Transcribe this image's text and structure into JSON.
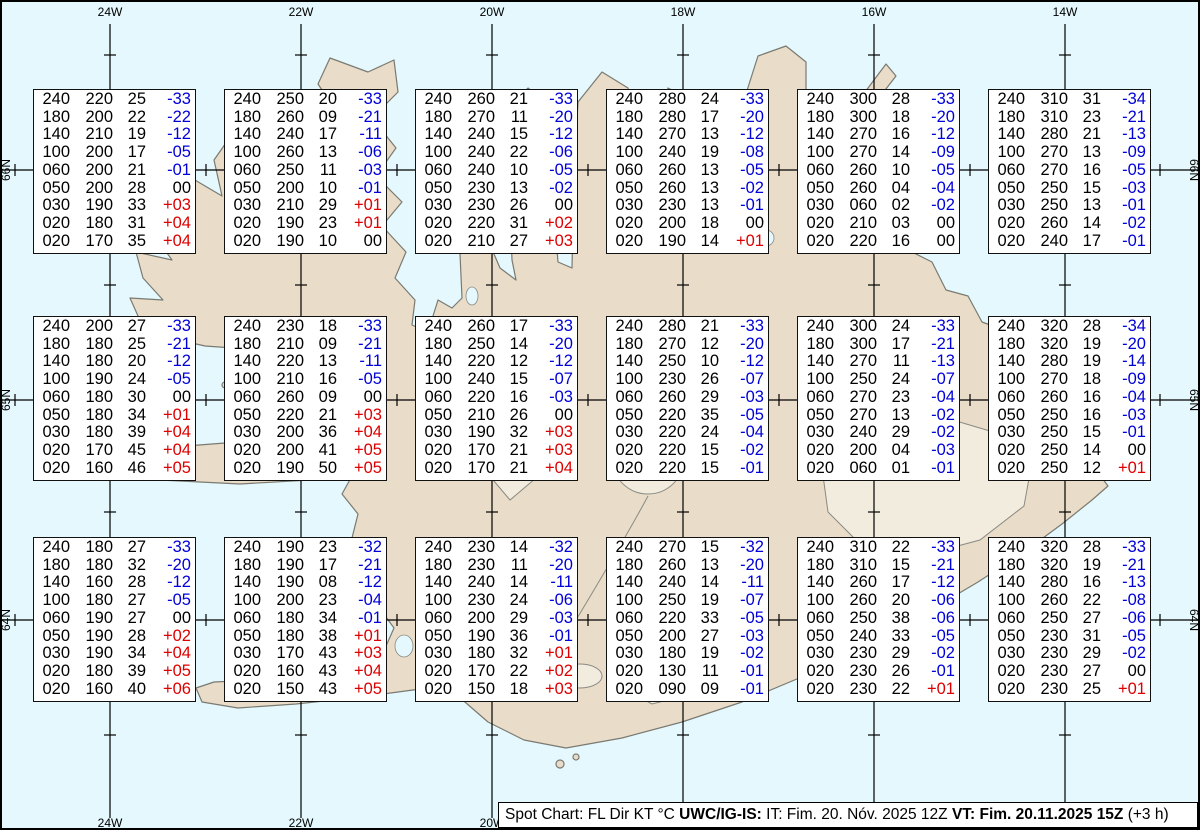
{
  "colors": {
    "ocean": "#e4f8fd",
    "land": "#e9dcc8",
    "glacier": "#f2ecdf",
    "coast": "#7a7a72",
    "grid": "#000000",
    "temp_negative": "#0000d8",
    "temp_positive": "#dd0000"
  },
  "grid": {
    "meridians": [
      {
        "label": "24W",
        "x": 110
      },
      {
        "label": "22W",
        "x": 301
      },
      {
        "label": "20W",
        "x": 492
      },
      {
        "label": "18W",
        "x": 683
      },
      {
        "label": "16W",
        "x": 874
      },
      {
        "label": "14W",
        "x": 1065
      }
    ],
    "parallels": [
      {
        "label": "66N",
        "y": 170
      },
      {
        "label": "65N",
        "y": 400
      },
      {
        "label": "64N",
        "y": 620
      }
    ],
    "minor_meridian_x": [
      15,
      206,
      397,
      588,
      779,
      970,
      1160
    ],
    "minor_parallel_y": [
      55,
      285,
      512,
      735
    ]
  },
  "spot_boxes": [
    {
      "row": 1,
      "col": 1,
      "lines": [
        [
          "240",
          "220",
          "25",
          "-33"
        ],
        [
          "180",
          "200",
          "22",
          "-22"
        ],
        [
          "140",
          "210",
          "19",
          "-12"
        ],
        [
          "100",
          "200",
          "17",
          "-05"
        ],
        [
          "060",
          "200",
          "21",
          "-01"
        ],
        [
          "050",
          "200",
          "28",
          "00"
        ],
        [
          "030",
          "190",
          "33",
          "+03"
        ],
        [
          "020",
          "180",
          "31",
          "+04"
        ],
        [
          "020",
          "170",
          "35",
          "+04"
        ]
      ]
    },
    {
      "row": 1,
      "col": 2,
      "lines": [
        [
          "240",
          "250",
          "20",
          "-33"
        ],
        [
          "180",
          "260",
          "09",
          "-21"
        ],
        [
          "140",
          "240",
          "17",
          "-11"
        ],
        [
          "100",
          "260",
          "13",
          "-06"
        ],
        [
          "060",
          "250",
          "11",
          "-03"
        ],
        [
          "050",
          "200",
          "10",
          "-01"
        ],
        [
          "030",
          "210",
          "29",
          "+01"
        ],
        [
          "020",
          "190",
          "23",
          "+01"
        ],
        [
          "020",
          "190",
          "10",
          "00"
        ]
      ]
    },
    {
      "row": 1,
      "col": 3,
      "lines": [
        [
          "240",
          "260",
          "21",
          "-33"
        ],
        [
          "180",
          "270",
          "11",
          "-20"
        ],
        [
          "140",
          "240",
          "15",
          "-12"
        ],
        [
          "100",
          "240",
          "22",
          "-06"
        ],
        [
          "060",
          "240",
          "10",
          "-05"
        ],
        [
          "050",
          "230",
          "13",
          "-02"
        ],
        [
          "030",
          "230",
          "26",
          "00"
        ],
        [
          "020",
          "220",
          "31",
          "+02"
        ],
        [
          "020",
          "210",
          "27",
          "+03"
        ]
      ]
    },
    {
      "row": 1,
      "col": 4,
      "lines": [
        [
          "240",
          "280",
          "24",
          "-33"
        ],
        [
          "180",
          "280",
          "17",
          "-20"
        ],
        [
          "140",
          "270",
          "13",
          "-12"
        ],
        [
          "100",
          "240",
          "19",
          "-08"
        ],
        [
          "060",
          "260",
          "13",
          "-05"
        ],
        [
          "050",
          "260",
          "13",
          "-02"
        ],
        [
          "030",
          "230",
          "13",
          "-01"
        ],
        [
          "020",
          "200",
          "18",
          "00"
        ],
        [
          "020",
          "190",
          "14",
          "+01"
        ]
      ]
    },
    {
      "row": 1,
      "col": 5,
      "lines": [
        [
          "240",
          "300",
          "28",
          "-33"
        ],
        [
          "180",
          "300",
          "18",
          "-20"
        ],
        [
          "140",
          "270",
          "16",
          "-12"
        ],
        [
          "100",
          "270",
          "14",
          "-09"
        ],
        [
          "060",
          "260",
          "10",
          "-05"
        ],
        [
          "050",
          "260",
          "04",
          "-04"
        ],
        [
          "030",
          "060",
          "02",
          "-02"
        ],
        [
          "020",
          "210",
          "03",
          "00"
        ],
        [
          "020",
          "220",
          "16",
          "00"
        ]
      ]
    },
    {
      "row": 1,
      "col": 6,
      "lines": [
        [
          "240",
          "310",
          "31",
          "-34"
        ],
        [
          "180",
          "310",
          "23",
          "-21"
        ],
        [
          "140",
          "280",
          "21",
          "-13"
        ],
        [
          "100",
          "270",
          "13",
          "-09"
        ],
        [
          "060",
          "270",
          "16",
          "-05"
        ],
        [
          "050",
          "250",
          "15",
          "-03"
        ],
        [
          "030",
          "250",
          "13",
          "-01"
        ],
        [
          "020",
          "260",
          "14",
          "-02"
        ],
        [
          "020",
          "240",
          "17",
          "-01"
        ]
      ]
    },
    {
      "row": 2,
      "col": 1,
      "lines": [
        [
          "240",
          "200",
          "27",
          "-33"
        ],
        [
          "180",
          "180",
          "25",
          "-21"
        ],
        [
          "140",
          "180",
          "20",
          "-12"
        ],
        [
          "100",
          "190",
          "24",
          "-05"
        ],
        [
          "060",
          "180",
          "30",
          "00"
        ],
        [
          "050",
          "180",
          "34",
          "+01"
        ],
        [
          "030",
          "180",
          "39",
          "+04"
        ],
        [
          "020",
          "170",
          "45",
          "+04"
        ],
        [
          "020",
          "160",
          "46",
          "+05"
        ]
      ]
    },
    {
      "row": 2,
      "col": 2,
      "lines": [
        [
          "240",
          "230",
          "18",
          "-33"
        ],
        [
          "180",
          "210",
          "09",
          "-21"
        ],
        [
          "140",
          "220",
          "13",
          "-11"
        ],
        [
          "100",
          "210",
          "16",
          "-05"
        ],
        [
          "060",
          "260",
          "09",
          "00"
        ],
        [
          "050",
          "220",
          "21",
          "+03"
        ],
        [
          "030",
          "200",
          "36",
          "+04"
        ],
        [
          "020",
          "200",
          "41",
          "+05"
        ],
        [
          "020",
          "190",
          "50",
          "+05"
        ]
      ]
    },
    {
      "row": 2,
      "col": 3,
      "lines": [
        [
          "240",
          "260",
          "17",
          "-33"
        ],
        [
          "180",
          "250",
          "14",
          "-20"
        ],
        [
          "140",
          "220",
          "12",
          "-12"
        ],
        [
          "100",
          "240",
          "15",
          "-07"
        ],
        [
          "060",
          "220",
          "16",
          "-03"
        ],
        [
          "050",
          "210",
          "26",
          "00"
        ],
        [
          "030",
          "190",
          "32",
          "+03"
        ],
        [
          "020",
          "170",
          "21",
          "+03"
        ],
        [
          "020",
          "170",
          "21",
          "+04"
        ]
      ]
    },
    {
      "row": 2,
      "col": 4,
      "lines": [
        [
          "240",
          "280",
          "21",
          "-33"
        ],
        [
          "180",
          "270",
          "12",
          "-20"
        ],
        [
          "140",
          "250",
          "10",
          "-12"
        ],
        [
          "100",
          "230",
          "26",
          "-07"
        ],
        [
          "060",
          "260",
          "29",
          "-03"
        ],
        [
          "050",
          "220",
          "35",
          "-05"
        ],
        [
          "030",
          "220",
          "24",
          "-04"
        ],
        [
          "020",
          "220",
          "15",
          "-02"
        ],
        [
          "020",
          "220",
          "15",
          "-01"
        ]
      ]
    },
    {
      "row": 2,
      "col": 5,
      "lines": [
        [
          "240",
          "300",
          "24",
          "-33"
        ],
        [
          "180",
          "300",
          "17",
          "-21"
        ],
        [
          "140",
          "270",
          "11",
          "-13"
        ],
        [
          "100",
          "250",
          "24",
          "-07"
        ],
        [
          "060",
          "270",
          "23",
          "-04"
        ],
        [
          "050",
          "270",
          "13",
          "-02"
        ],
        [
          "030",
          "240",
          "29",
          "-02"
        ],
        [
          "020",
          "200",
          "04",
          "-03"
        ],
        [
          "020",
          "060",
          "01",
          "-01"
        ]
      ]
    },
    {
      "row": 2,
      "col": 6,
      "lines": [
        [
          "240",
          "320",
          "28",
          "-34"
        ],
        [
          "180",
          "320",
          "19",
          "-20"
        ],
        [
          "140",
          "280",
          "19",
          "-14"
        ],
        [
          "100",
          "270",
          "18",
          "-09"
        ],
        [
          "060",
          "260",
          "16",
          "-04"
        ],
        [
          "050",
          "250",
          "16",
          "-03"
        ],
        [
          "030",
          "250",
          "15",
          "-01"
        ],
        [
          "020",
          "250",
          "14",
          "00"
        ],
        [
          "020",
          "250",
          "12",
          "+01"
        ]
      ]
    },
    {
      "row": 3,
      "col": 1,
      "lines": [
        [
          "240",
          "180",
          "27",
          "-33"
        ],
        [
          "180",
          "180",
          "32",
          "-20"
        ],
        [
          "140",
          "160",
          "28",
          "-12"
        ],
        [
          "100",
          "180",
          "27",
          "-05"
        ],
        [
          "060",
          "190",
          "27",
          "00"
        ],
        [
          "050",
          "190",
          "28",
          "+02"
        ],
        [
          "030",
          "190",
          "34",
          "+04"
        ],
        [
          "020",
          "180",
          "39",
          "+05"
        ],
        [
          "020",
          "160",
          "40",
          "+06"
        ]
      ]
    },
    {
      "row": 3,
      "col": 2,
      "lines": [
        [
          "240",
          "190",
          "23",
          "-32"
        ],
        [
          "180",
          "190",
          "17",
          "-21"
        ],
        [
          "140",
          "190",
          "08",
          "-12"
        ],
        [
          "100",
          "200",
          "23",
          "-04"
        ],
        [
          "060",
          "180",
          "34",
          "-01"
        ],
        [
          "050",
          "180",
          "38",
          "+01"
        ],
        [
          "030",
          "170",
          "43",
          "+03"
        ],
        [
          "020",
          "160",
          "43",
          "+04"
        ],
        [
          "020",
          "150",
          "43",
          "+05"
        ]
      ]
    },
    {
      "row": 3,
      "col": 3,
      "lines": [
        [
          "240",
          "230",
          "14",
          "-32"
        ],
        [
          "180",
          "230",
          "11",
          "-20"
        ],
        [
          "140",
          "240",
          "14",
          "-11"
        ],
        [
          "100",
          "230",
          "24",
          "-06"
        ],
        [
          "060",
          "200",
          "29",
          "-03"
        ],
        [
          "050",
          "190",
          "36",
          "-01"
        ],
        [
          "030",
          "180",
          "32",
          "+01"
        ],
        [
          "020",
          "170",
          "22",
          "+02"
        ],
        [
          "020",
          "150",
          "18",
          "+03"
        ]
      ]
    },
    {
      "row": 3,
      "col": 4,
      "lines": [
        [
          "240",
          "270",
          "15",
          "-32"
        ],
        [
          "180",
          "260",
          "13",
          "-20"
        ],
        [
          "140",
          "240",
          "14",
          "-11"
        ],
        [
          "100",
          "250",
          "19",
          "-07"
        ],
        [
          "060",
          "220",
          "33",
          "-05"
        ],
        [
          "050",
          "200",
          "27",
          "-03"
        ],
        [
          "030",
          "180",
          "19",
          "-02"
        ],
        [
          "020",
          "130",
          "11",
          "-01"
        ],
        [
          "020",
          "090",
          "09",
          "-01"
        ]
      ]
    },
    {
      "row": 3,
      "col": 5,
      "lines": [
        [
          "240",
          "310",
          "22",
          "-33"
        ],
        [
          "180",
          "310",
          "15",
          "-21"
        ],
        [
          "140",
          "260",
          "17",
          "-12"
        ],
        [
          "100",
          "260",
          "20",
          "-06"
        ],
        [
          "060",
          "250",
          "38",
          "-06"
        ],
        [
          "050",
          "240",
          "33",
          "-05"
        ],
        [
          "030",
          "230",
          "29",
          "-02"
        ],
        [
          "020",
          "230",
          "26",
          "-01"
        ],
        [
          "020",
          "230",
          "22",
          "+01"
        ]
      ]
    },
    {
      "row": 3,
      "col": 6,
      "lines": [
        [
          "240",
          "320",
          "28",
          "-33"
        ],
        [
          "180",
          "320",
          "19",
          "-21"
        ],
        [
          "140",
          "280",
          "16",
          "-13"
        ],
        [
          "100",
          "260",
          "22",
          "-08"
        ],
        [
          "060",
          "250",
          "27",
          "-06"
        ],
        [
          "050",
          "230",
          "31",
          "-05"
        ],
        [
          "030",
          "230",
          "29",
          "-02"
        ],
        [
          "020",
          "230",
          "27",
          "00"
        ],
        [
          "020",
          "230",
          "25",
          "+01"
        ]
      ]
    }
  ],
  "box_layout": {
    "left0": 33,
    "col_step": 191,
    "width": 163,
    "row_tops": [
      89,
      316,
      537
    ],
    "height": 165
  },
  "footer": {
    "segments": [
      {
        "text": "Spot Chart: FL Dir KT °C ",
        "bold": false
      },
      {
        "text": "UWC/IG-IS:",
        "bold": true
      },
      {
        "text": " IT: Fim. 20. Nóv. 2025 12Z ",
        "bold": false
      },
      {
        "text": "VT: Fim. 20.11.2025 15Z",
        "bold": true
      },
      {
        "text": " (+3 h)",
        "bold": false
      }
    ]
  }
}
